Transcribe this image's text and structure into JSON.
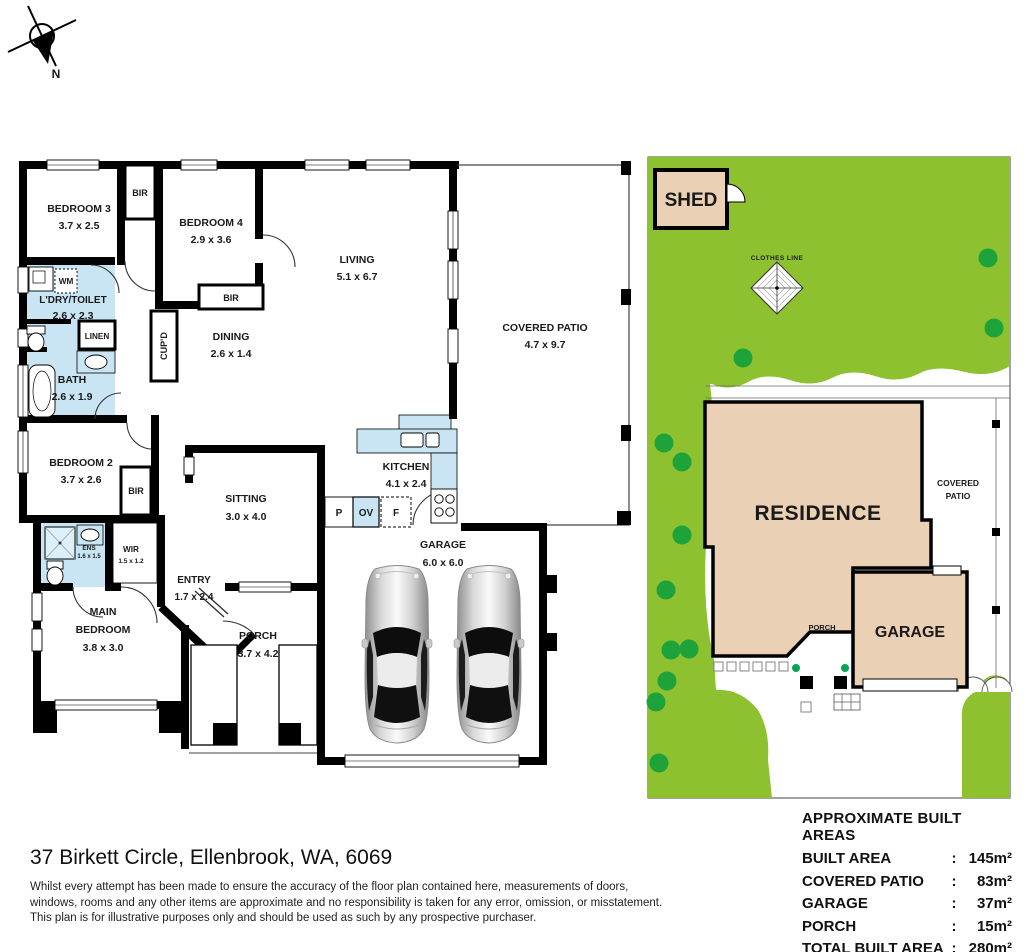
{
  "compass": {
    "label": "N"
  },
  "floor_plan": {
    "rooms": [
      {
        "name": "BEDROOM 3",
        "dims": "3.7 x 2.5"
      },
      {
        "name": "BEDROOM 4",
        "dims": "2.9 x 3.6"
      },
      {
        "name": "LIVING",
        "dims": "5.1 x 6.7"
      },
      {
        "name": "L'DRY/TOILET",
        "dims": "2.6 x 2.3"
      },
      {
        "name": "DINING",
        "dims": "2.6 x 1.4"
      },
      {
        "name": "COVERED PATIO",
        "dims": "4.7 x 9.7"
      },
      {
        "name": "BATH",
        "dims": "2.6 x 1.9"
      },
      {
        "name": "BEDROOM 2",
        "dims": "3.7 x 2.6"
      },
      {
        "name": "KITCHEN",
        "dims": "4.1 x 2.4"
      },
      {
        "name": "SITTING",
        "dims": "3.0 x 4.0"
      },
      {
        "name": "GARAGE",
        "dims": "6.0 x 6.0"
      },
      {
        "name": "ENS",
        "dims": "1.6 x 1.5"
      },
      {
        "name": "WIR",
        "dims": "1.5 x 1.2"
      },
      {
        "name": "ENTRY",
        "dims": "1.7 x 2.4"
      },
      {
        "name": "MAIN BEDROOM",
        "line1": "MAIN",
        "line2": "BEDROOM",
        "dims": "3.8 x 3.0"
      },
      {
        "name": "PORCH",
        "dims": "3.7 x 4.2"
      }
    ],
    "labels": {
      "bir": "BIR",
      "linen": "LINEN",
      "cupd": "CUP'D",
      "wm": "WM",
      "pantry": "P",
      "oven": "OV",
      "fridge": "F"
    }
  },
  "site_plan": {
    "shed": "SHED",
    "clothes_line": "CLOTHES LINE",
    "residence": "RESIDENCE",
    "covered_patio_line1": "COVERED",
    "covered_patio_line2": "PATIO",
    "porch": "PORCH",
    "garage": "GARAGE"
  },
  "areas": {
    "title": "APPROXIMATE BUILT AREAS",
    "rows": [
      {
        "label": "BUILT AREA",
        "sep": ":",
        "value": "145m²"
      },
      {
        "label": "COVERED PATIO",
        "sep": ":",
        "value": "83m²"
      },
      {
        "label": "GARAGE",
        "sep": ":",
        "value": "37m²"
      },
      {
        "label": "PORCH",
        "sep": ":",
        "value": "15m²"
      },
      {
        "label": "TOTAL BUILT AREA",
        "sep": ":",
        "value": "280m²"
      }
    ]
  },
  "footer": {
    "address": "37 Birkett Circle, Ellenbrook, WA, 6069",
    "disclaimer_lines": [
      "Whilst every attempt has been made to ensure the accuracy of the floor plan contained here, measurements of doors,",
      "windows, rooms and any other items are approximate and no responsibility is taken for any error, omission, or misstatement.",
      "This plan is for illustrative purposes only and should be used as such by any prospective purchaser."
    ]
  },
  "colors": {
    "grass": "#8dc12f",
    "tree": "#1ea33a",
    "shrub_dot": "#00a651",
    "wet_blue": "#c9e5f4",
    "building_tan": "#ead0b5",
    "wall": "#000000"
  }
}
